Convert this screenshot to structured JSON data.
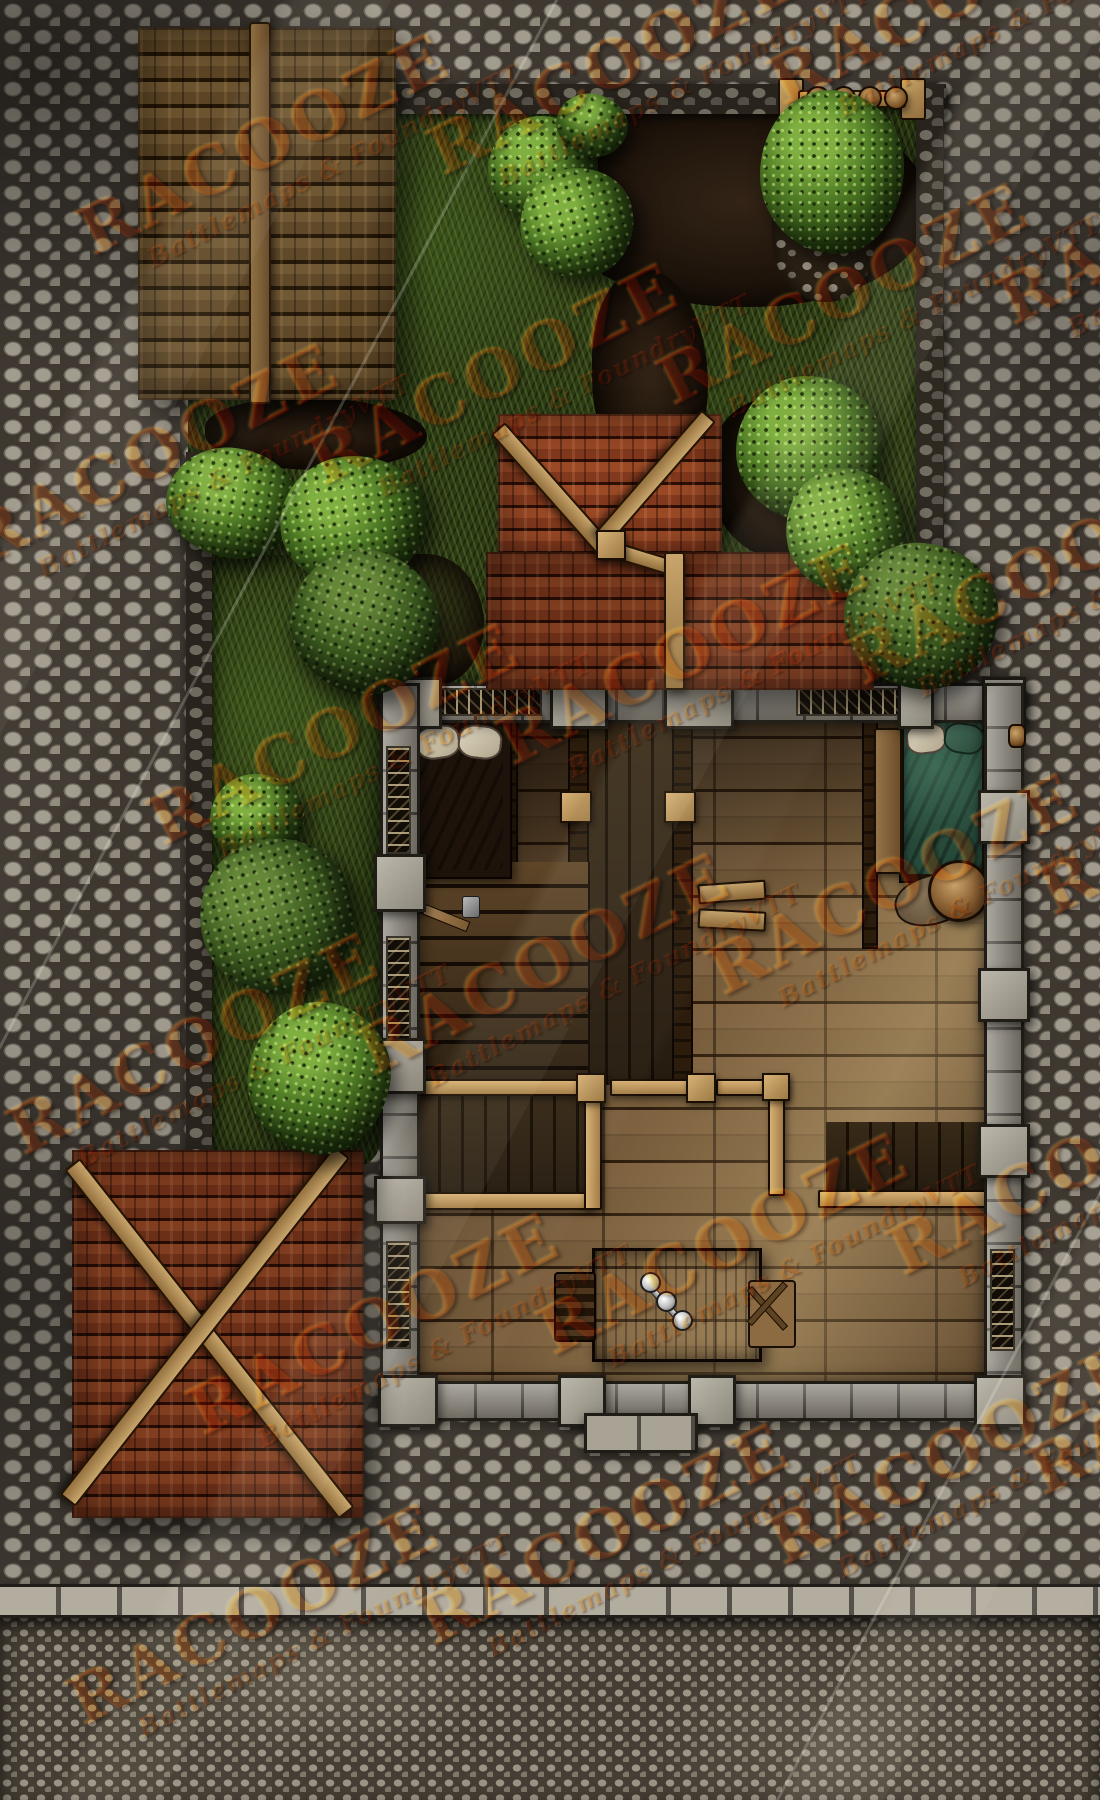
{
  "watermark": {
    "line1": "RACOOZE",
    "line2": "Battlemaps & FoundryVTT",
    "angle_deg": -27,
    "color": "#cd8c3c",
    "positions": [
      [
        70,
        210
      ],
      [
        420,
        130
      ],
      [
        760,
        60
      ],
      [
        -40,
        520
      ],
      [
        300,
        440
      ],
      [
        650,
        360
      ],
      [
        990,
        280
      ],
      [
        140,
        800
      ],
      [
        490,
        720
      ],
      [
        840,
        640
      ],
      [
        0,
        1110
      ],
      [
        350,
        1030
      ],
      [
        700,
        950
      ],
      [
        1030,
        870
      ],
      [
        180,
        1390
      ],
      [
        530,
        1310
      ],
      [
        880,
        1230
      ],
      [
        60,
        1680
      ],
      [
        410,
        1600
      ],
      [
        760,
        1520
      ],
      [
        1020,
        1450
      ]
    ]
  },
  "map": {
    "type": "top-down fantasy battlemap",
    "grid_visible": false,
    "palette": {
      "street_stone": "#8f897c",
      "lower_street_pebbles": "#7e776a",
      "curb": "#b3ada0",
      "grass": "#3a4a1d",
      "dirt": "#241910",
      "garden_wall": "#5d574d",
      "shingle_roof": "#5e4626",
      "red_tile_roof": "#8a3e20",
      "building_wall": "#8b867b",
      "wood_floor": "#6f563a",
      "railing_wood": "#c8a56c",
      "green_bed": "#27493a",
      "dark_bed": "#2a1b10"
    },
    "regions": [
      {
        "name": "cobblestone-street"
      },
      {
        "name": "lower-street-pebbles"
      },
      {
        "name": "street-curb"
      },
      {
        "name": "garden-grass"
      },
      {
        "name": "dirt-paths"
      },
      {
        "name": "garden-stone-wall"
      },
      {
        "name": "wooden-shingle-roof"
      },
      {
        "name": "red-tile-porch-roof"
      },
      {
        "name": "red-tile-annex-roof"
      },
      {
        "name": "stone-walled-building-interior"
      }
    ],
    "objects": [
      {
        "name": "garden-gate",
        "detail": "log rail with 4 round posts"
      },
      {
        "name": "dark-bed",
        "detail": "two pillows"
      },
      {
        "name": "green-bed",
        "detail": "two pillows"
      },
      {
        "name": "bedside-bench"
      },
      {
        "name": "sack"
      },
      {
        "name": "barrel"
      },
      {
        "name": "dining-table"
      },
      {
        "name": "candelabra",
        "candles": 3
      },
      {
        "name": "dark-chair"
      },
      {
        "name": "tan-chair"
      },
      {
        "name": "sawhorse-benches",
        "count": 2
      },
      {
        "name": "stairwell-with-railings"
      },
      {
        "name": "floor-openings-with-railings",
        "count": 2
      },
      {
        "name": "bushes-and-trees",
        "count": 13
      },
      {
        "name": "hatchet"
      },
      {
        "name": "door-knob-east-wall"
      },
      {
        "name": "entrance-step"
      }
    ]
  }
}
